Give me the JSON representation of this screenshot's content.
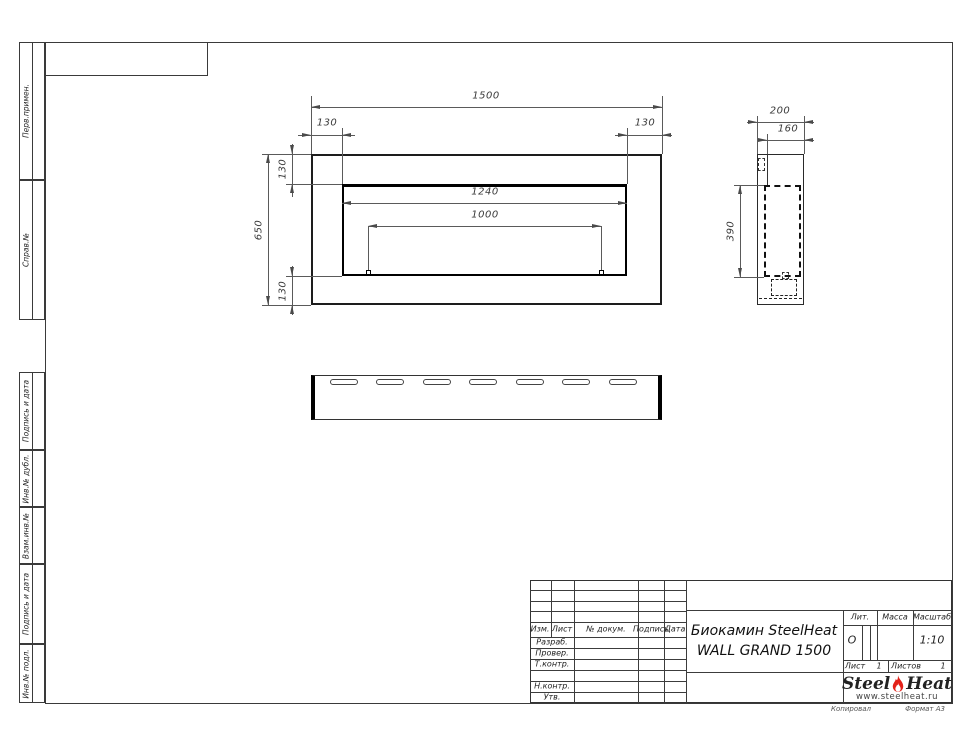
{
  "sidebar": {
    "top_items": [
      {
        "label": "Перв.примен."
      },
      {
        "label": "Справ.№"
      }
    ],
    "bottom_items": [
      {
        "label": "Подпись и дата"
      },
      {
        "label": "Инв.№ дубл."
      },
      {
        "label": "Взам.инв.№"
      },
      {
        "label": "Подпись и дата"
      },
      {
        "label": "Инв.№ подл."
      }
    ]
  },
  "views": {
    "front": {
      "width": "1500",
      "left_offset": "130",
      "right_offset": "130",
      "height": "650",
      "top_offset": "130",
      "bottom_offset": "130",
      "opening_width": "1240",
      "burner_width": "1000"
    },
    "side": {
      "depth": "200",
      "inner_depth": "160",
      "firebox_height": "390"
    }
  },
  "title_block": {
    "columns": [
      "Изм.",
      "Лист",
      "№ докум.",
      "Подпись",
      "Дата"
    ],
    "rows": [
      "Разраб.",
      "Провер.",
      "Т.контр.",
      "Н.контр.",
      "Утв."
    ],
    "product_line1": "Биокамин SteelHeat",
    "product_line2": "WALL GRAND 1500",
    "lit_label": "Лит.",
    "lit_value": "О",
    "mass_label": "Масса",
    "scale_label": "Масштаб",
    "scale_value": "1:10",
    "sheet_label": "Лист",
    "sheet_value": "1",
    "sheets_label": "Листов",
    "sheets_value": "1"
  },
  "logo": {
    "part1": "Steel",
    "part2": "Heat",
    "url": "www.steelheat.ru"
  },
  "footer": {
    "kopiroval": "Копировал",
    "format": "Формат А3"
  },
  "colors": {
    "flame": "#e32119",
    "line": "#4a4a4a",
    "object": "#111111"
  }
}
